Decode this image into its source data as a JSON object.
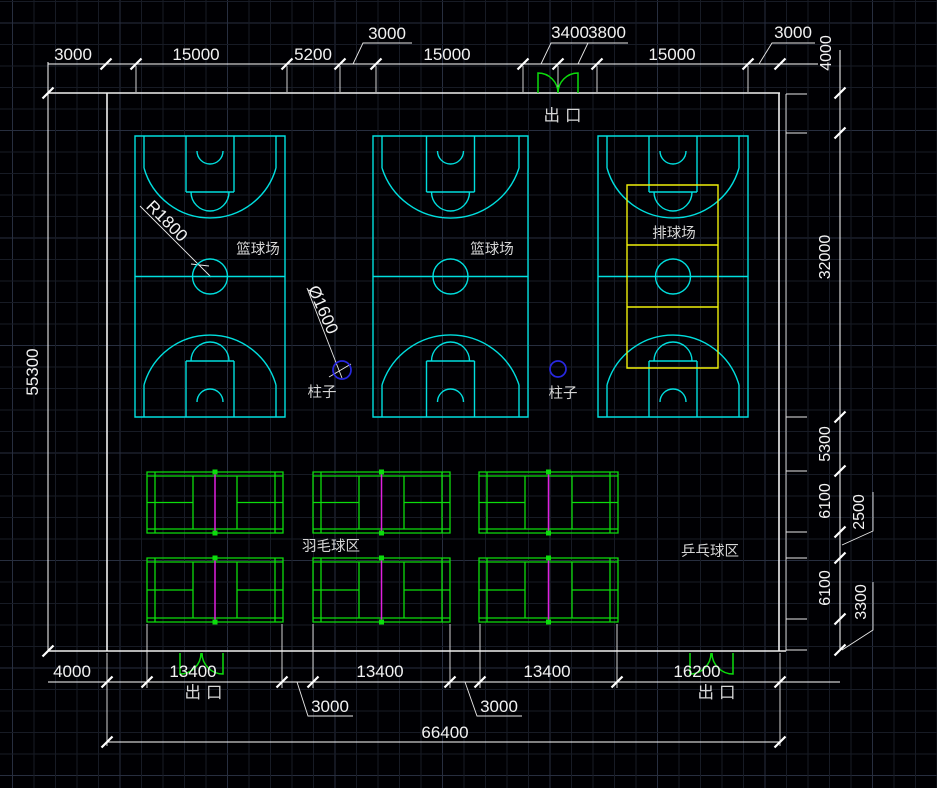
{
  "drawing": {
    "type": "CAD floor plan of a sports hall",
    "colors": {
      "background": "#000003",
      "grid_minor": "#171b25",
      "grid_major": "#272e3f",
      "wall": "#f0f0f0",
      "dimension": "#ffffff",
      "basketball_court": "#00dede",
      "volleyball_court": "#f0f00a",
      "badminton_court": "#0cdc0c",
      "net": "#e020e0",
      "column": "#2828e0",
      "door": "#0cdc0c",
      "label_text": "#d6d6d6"
    }
  },
  "labels": {
    "exit": "出口",
    "basketball_court": "篮球场",
    "volleyball_court": "排球场",
    "badminton_area": "羽毛球区",
    "table_tennis_area": "乒乓球区",
    "column": "柱子",
    "radius_annotation": "R1800",
    "diameter_annotation": "Ø1600"
  },
  "dimensions": {
    "top": [
      "3000",
      "15000",
      "5200",
      "3000",
      "15000",
      "3400",
      "3800",
      "15000",
      "3000"
    ],
    "bottom": [
      "4000",
      "13400",
      "3000",
      "13400",
      "3000",
      "13400",
      "16200"
    ],
    "bottom_total": "66400",
    "left": "55300",
    "right": [
      "4000",
      "32000",
      "5300",
      "6100",
      "2500",
      "6100",
      "3300"
    ]
  }
}
